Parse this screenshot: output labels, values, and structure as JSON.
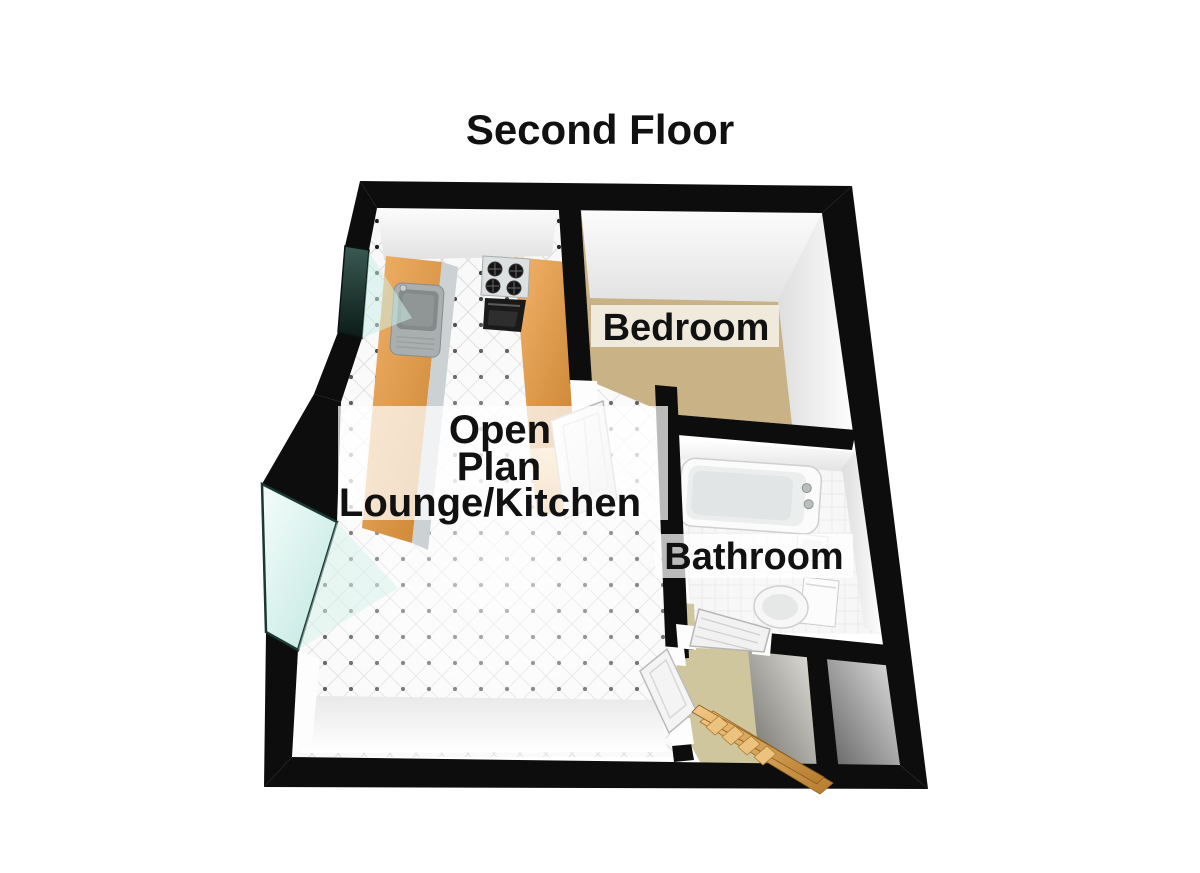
{
  "title": "Second Floor",
  "labels": {
    "bedroom": "Bedroom",
    "bathroom": "Bathroom",
    "lounge_line1": "Open",
    "lounge_line2": "Plan",
    "lounge_line3": "Lounge/Kitchen"
  },
  "fixtures": [
    "kitchen-sink",
    "gas-hob",
    "oven",
    "kitchen-counter",
    "bathtub",
    "toilet",
    "hand-basin",
    "staircase",
    "bay-window",
    "window",
    "bedroom-door",
    "bathroom-door",
    "hall-door"
  ],
  "colors": {
    "wall": "#0d0d0d",
    "bedroom_carpet": "#c8b286",
    "hall_floor": "#cfc69e",
    "counter_wood": "#e2a058",
    "window_glass": "#cdeee8",
    "window_glass_dark": "#1c3832",
    "lounge_tile": "#f8f8f9",
    "label_background": "rgba(255,255,255,0.72)",
    "text": "#111111",
    "background": "#ffffff"
  }
}
